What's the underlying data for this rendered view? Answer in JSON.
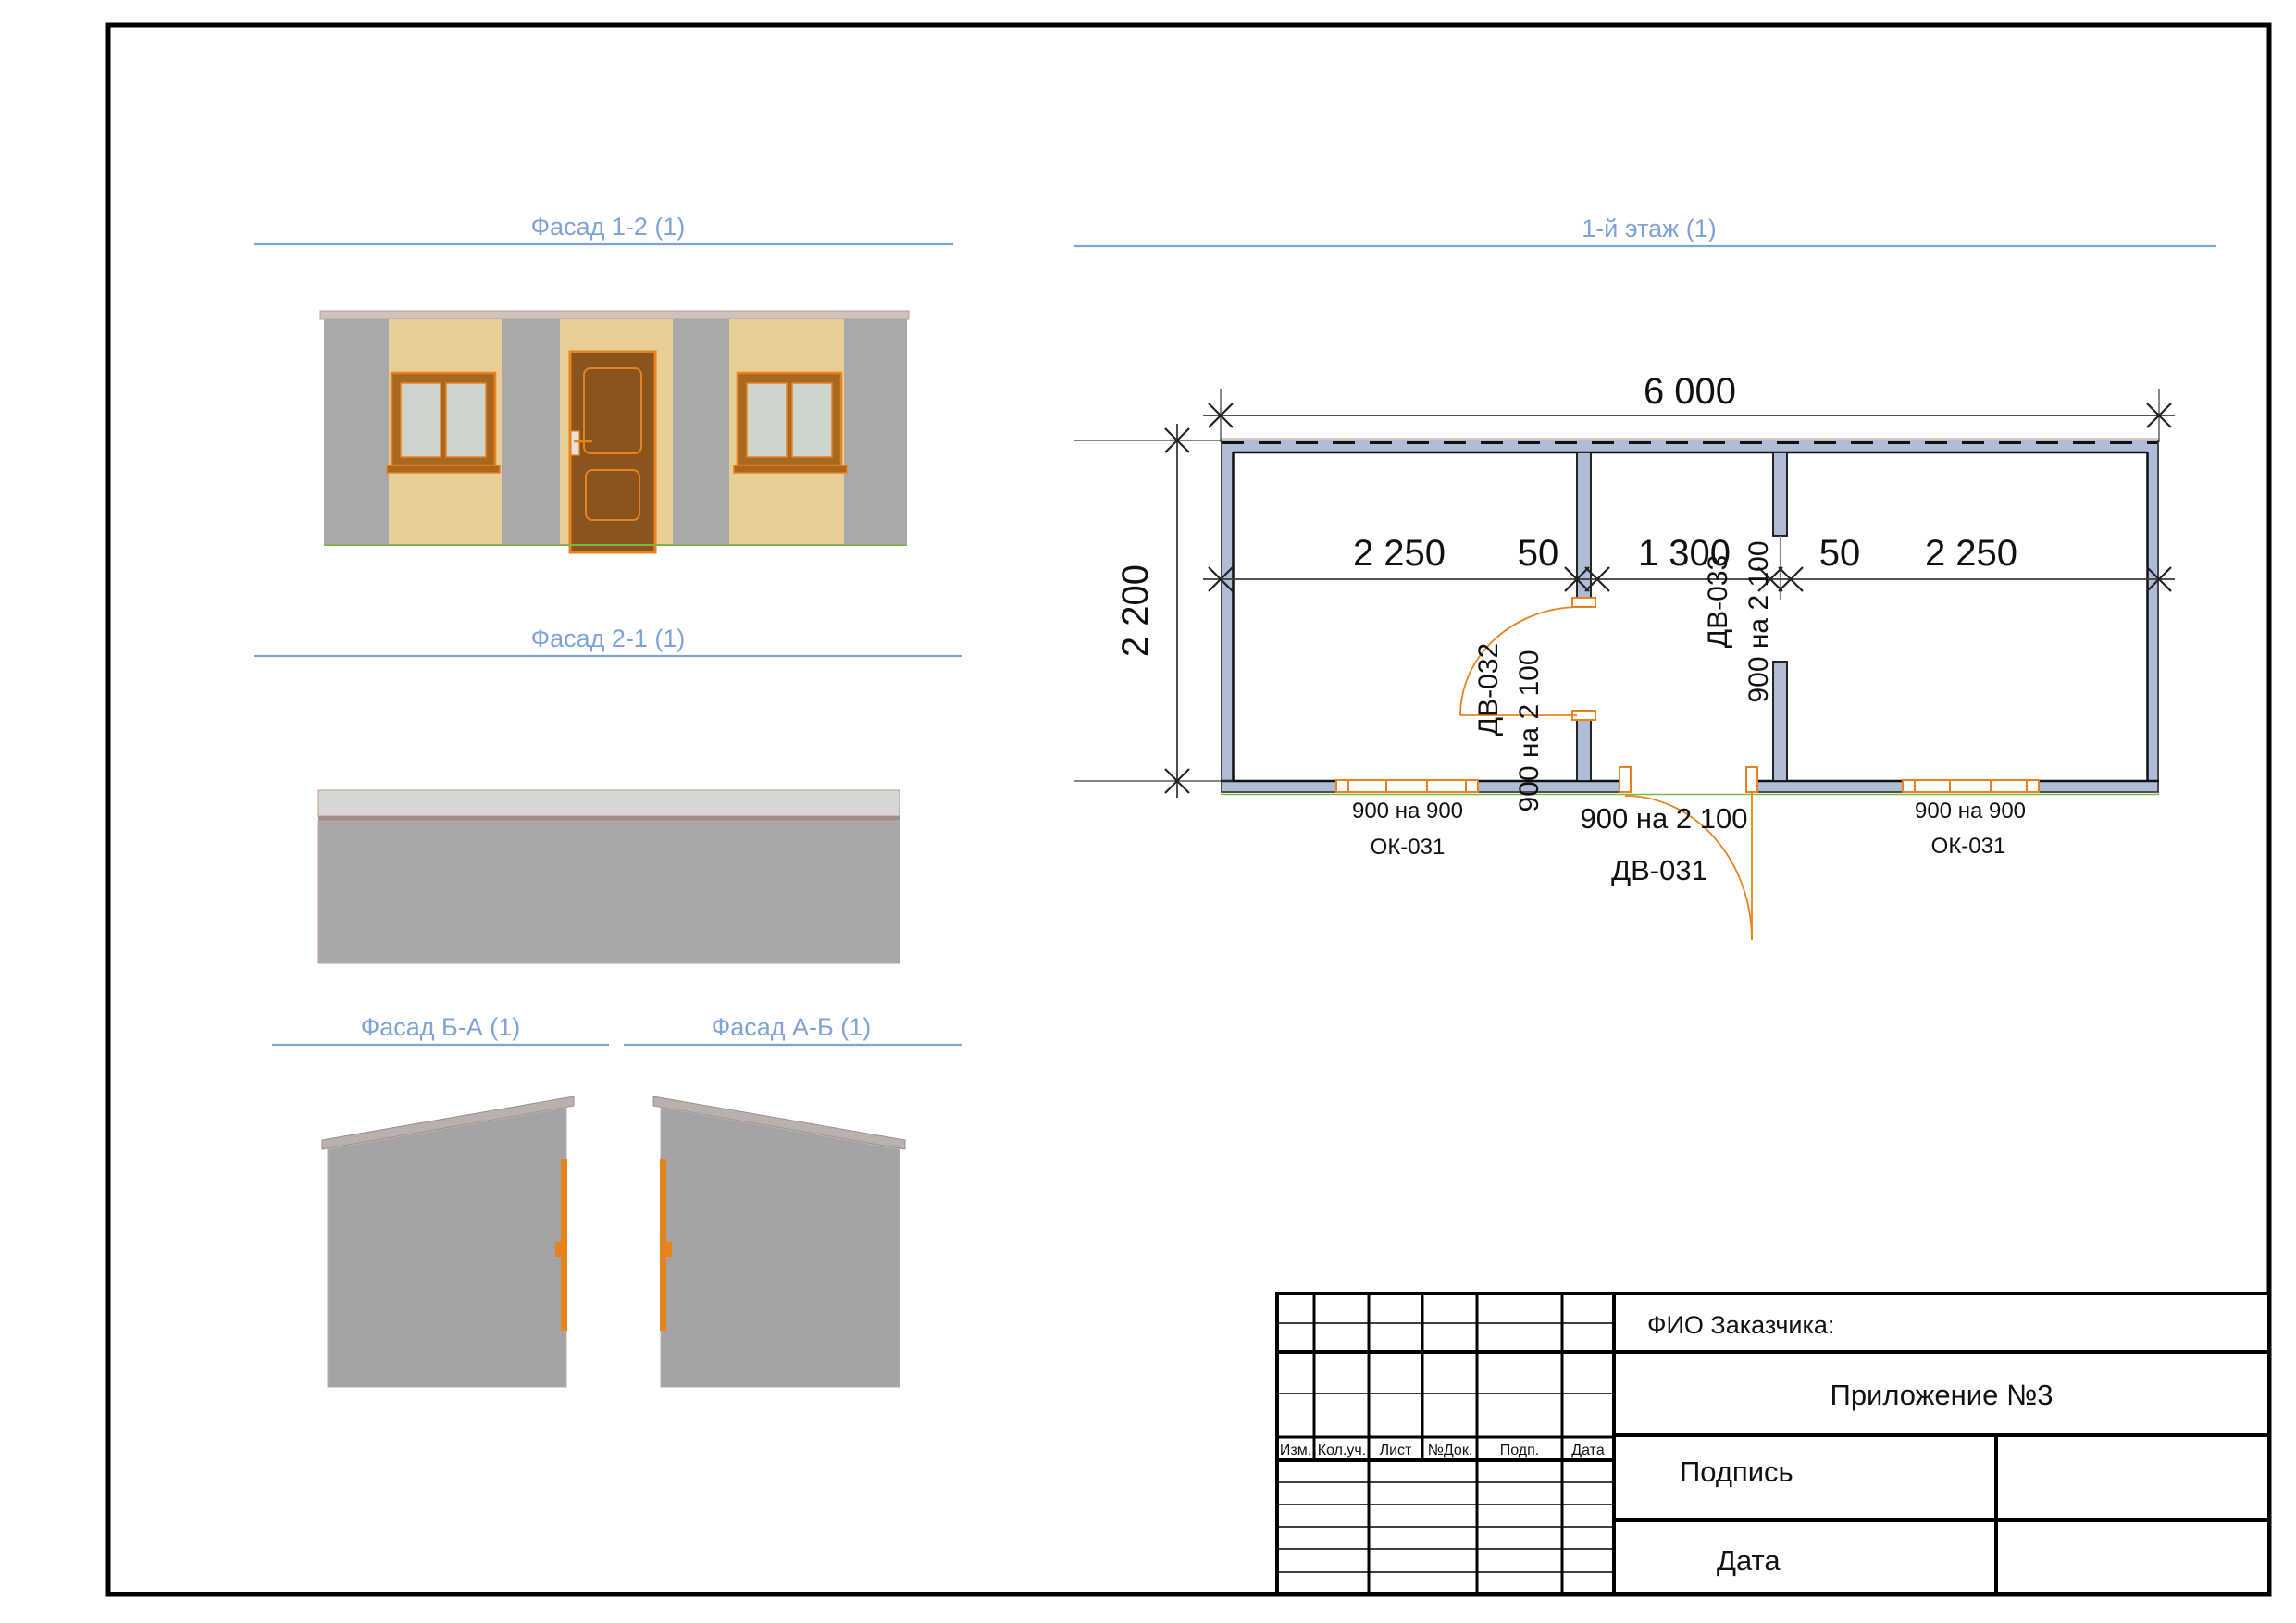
{
  "page": {
    "background": "#ffffff",
    "border_color": "#000000"
  },
  "colors": {
    "view_title_blue": "#7fa3d6",
    "plan_wall_fill": "#afbcd6",
    "drawing_orange": "#e8821e",
    "facade_tan": "#e9cd96",
    "facade_gray": "#a9a9ab",
    "door_brown": "#8a551c",
    "glass_gray": "#ccd4cc",
    "ground_green": "#7ab648",
    "roof_strip": "#cdc3bf"
  },
  "views": {
    "facade_1_2": {
      "title": "Фасад 1-2 (1)"
    },
    "facade_2_1": {
      "title": "Фасад 2-1 (1)"
    },
    "facade_ba": {
      "title": "Фасад Б-А (1)"
    },
    "facade_ab": {
      "title": "Фасад А-Б (1)"
    },
    "floor_plan": {
      "title": "1-й этаж (1)"
    }
  },
  "floor_plan": {
    "dim_total": "6 000",
    "dim_segments": [
      "2 250",
      "50",
      "1 300",
      "50",
      "2 250"
    ],
    "dim_height": "2 200",
    "doors": {
      "dv031": {
        "code": "ДВ-031",
        "size": "900 на 2 100"
      },
      "dv032": {
        "code": "ДВ-032",
        "size": "900 на 2 100"
      },
      "dv033": {
        "code": "ДВ-033",
        "size": "900 на 2 100"
      }
    },
    "windows": {
      "left": {
        "code": "ОК-031",
        "size": "900 на 900"
      },
      "right": {
        "code": "ОК-031",
        "size": "900 на 900"
      }
    }
  },
  "title_block": {
    "customer_label": "ФИО Заказчика:",
    "appendix": "Приложение №3",
    "signature_label": "Подпись",
    "date_label": "Дата",
    "columns": [
      "Изм.",
      "Кол.уч.",
      "Лист",
      "№Док.",
      "Подп.",
      "Дата"
    ]
  }
}
